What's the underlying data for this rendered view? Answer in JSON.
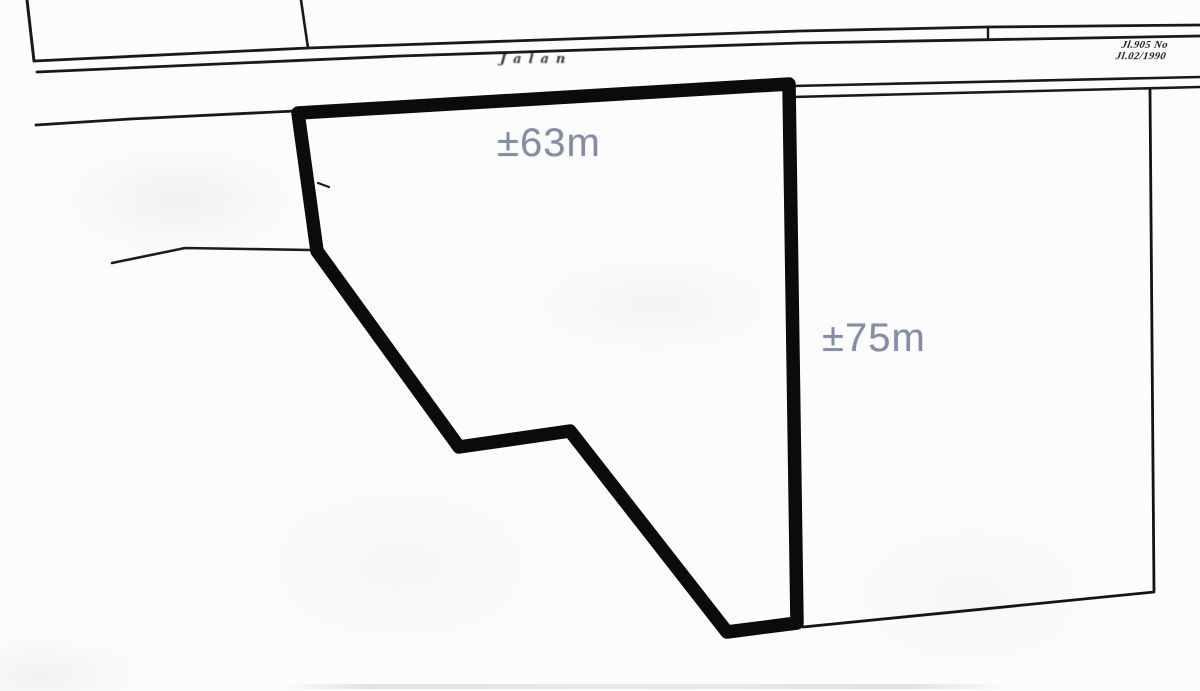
{
  "annotations": {
    "top_width_label": "±63m",
    "right_height_label": "±75m",
    "label_color": "#858da5"
  },
  "map_text": {
    "road_name": "Jalan",
    "stamp_line1": "Jl.905 No",
    "stamp_line2": "Jl.02/1990"
  },
  "colors": {
    "plot_outline": "#0b0b0b",
    "ink": "#191919",
    "paper": "#fcfcfc"
  },
  "shapes": {
    "plot_outline_points": "298,113 789,84 797,623 727,632 570,431 459,447 317,251",
    "upper_parcel_left_edge": "27,0 34,61",
    "upper_parcel_right_edge": "301,0 308,48",
    "road_top_line": "34,61 308,48 800,31 987,27 1200,25",
    "road_bottom_line": "37,72 400,56 800,43 1200,36",
    "road_join_tick": "988,27 988,38",
    "road_lower_band_top": "792,86 1200,77",
    "road_lower_band_bottom": "792,97 1200,87",
    "left_boundary_line": "36,125 130,119 295,111",
    "left_mid_line": "112,263 185,248 310,250",
    "right_parcel_line": "803,627 1154,592 1150,90",
    "left_edge_tick": "318,183 329,187"
  }
}
